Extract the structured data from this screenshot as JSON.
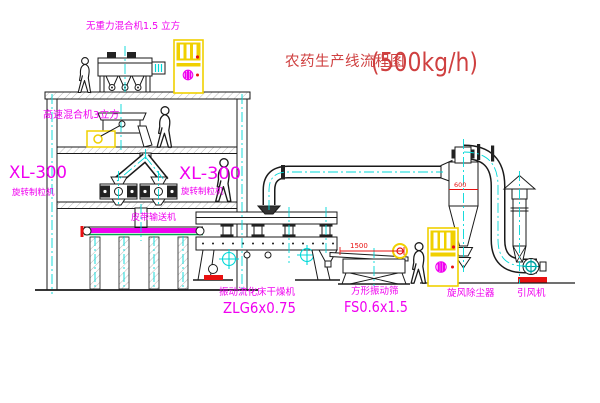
{
  "title": {
    "name_cn": "农药生产线流程图",
    "capacity": "(500kg/h)"
  },
  "labels": {
    "gravity_mixer": "无重力混合机1.5 立方",
    "high_speed_mixer": "高速混合机3立方",
    "granulator_left_model": "XL-300",
    "granulator_left_name": "旋转制粒机",
    "granulator_mid_model": "XL-300",
    "granulator_mid_name": "旋转制粒机",
    "belt_conveyor": "皮带输送机",
    "fluid_bed_dryer_name": "振动流化床干燥机",
    "fluid_bed_dryer_model": "ZLG6x0.75",
    "vibrating_screen_name": "方形振动筛",
    "vibrating_screen_model": "FS0.6x1.5",
    "cyclone_dust_collector": "旋风除尘器",
    "induced_draft_fan": "引风机"
  },
  "dimensions": {
    "cyclone_width": "600",
    "dryer_outlet_span": "1500"
  },
  "colors": {
    "magenta": "#f000f0",
    "cyan": "#00d8d8",
    "yellow": "#f0d000",
    "red": "#e81010",
    "title_red": "#cf4040",
    "green": "#00a84f",
    "teal": "#00a0a0",
    "ink": "#1a1a1a"
  }
}
